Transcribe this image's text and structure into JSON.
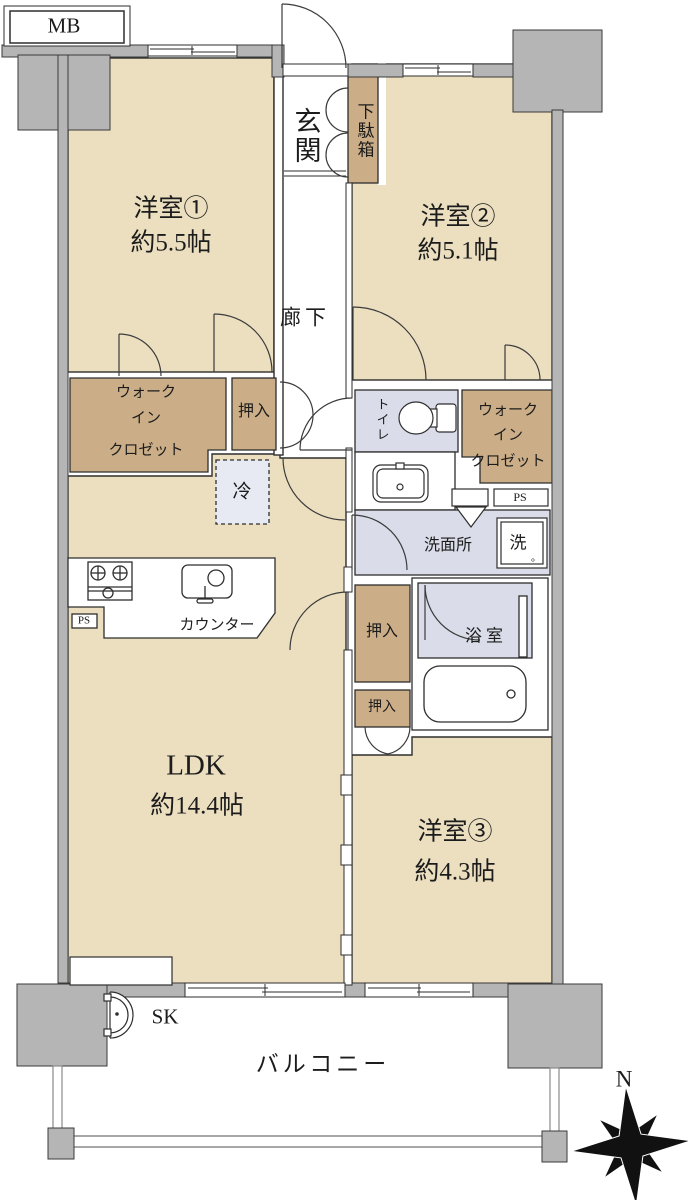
{
  "colors": {
    "room": "#ecdfc0",
    "closet": "#cbae87",
    "wet": "#dadde9",
    "wet_light": "#e7eaf2",
    "wall": "#b5b5b5",
    "line": "#2e2e2e",
    "text": "#1c1c1c"
  },
  "plan": {
    "mb": "MB",
    "room1_name": "洋室①",
    "room1_size": "約5.5帖",
    "room2_name": "洋室②",
    "room2_size": "約5.1帖",
    "room3_name": "洋室③",
    "room3_size": "約4.3帖",
    "ldk_name": "LDK",
    "ldk_size": "約14.4帖",
    "genkan": "玄関",
    "getabako": "下駄箱",
    "rouka": "廊下",
    "wic_line1": "ウォーク",
    "wic_line2": "イン",
    "wic_line3": "クロゼット",
    "oshiire": "押入",
    "rei": "冷",
    "toilet": "トイレ",
    "ps": "PS",
    "senmenjo": "洗面所",
    "sentaku": "洗",
    "maru": "。",
    "counter": "カウンター",
    "yokushitsu": "浴室",
    "sk": "SK",
    "balcony": "バルコニー",
    "north": "N"
  }
}
